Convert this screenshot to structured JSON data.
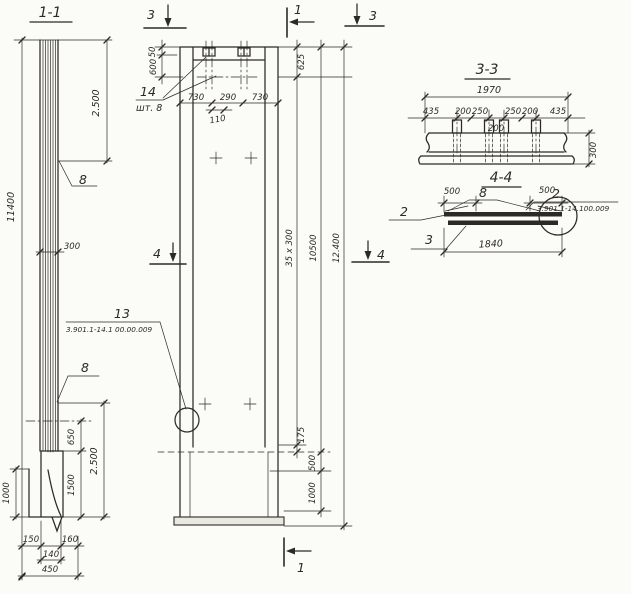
{
  "ink": "#2c2a25",
  "paper": "#fbfbf7",
  "s11": {
    "title": "1-1",
    "dim_total": "11400",
    "dim_top2500": "2.500",
    "dim_300": "300",
    "weld_top": "8",
    "weld_bottom": "8",
    "dim_650": "650",
    "dim_2500b": "2.500",
    "dim_1500": "1500",
    "dim_1000": "1000",
    "dim_150": "150",
    "dim_160": "160",
    "dim_140": "140",
    "dim_450": "450"
  },
  "elevation": {
    "cut3_left": "3",
    "cut3_right": "3",
    "cut1_top": "1",
    "cut1_bottom": "1",
    "cut4_left": "4",
    "cut4_right": "4",
    "dim_50": "50",
    "dim_600": "600",
    "pos_14": "14",
    "qty_14": "шт. 8",
    "dim_730a": "730",
    "dim_290": "290",
    "dim_730b": "730",
    "dim_110": "110",
    "dim_625": "625",
    "dim_35x300": "35 x 300",
    "dim_10500": "10500",
    "dim_12400": "12.400",
    "dim_175": "175",
    "dim_500": "500",
    "dim_1000": "1000",
    "pos_13": "13",
    "ref_13": "3.901.1-14.1 00.00.009"
  },
  "s33": {
    "title": "3-3",
    "dim_1970": "1970",
    "dims": [
      "435",
      "200",
      "250",
      "250",
      "200",
      "435"
    ],
    "dim_200c": "200",
    "dim_300": "300"
  },
  "s44": {
    "title": "4-4",
    "pos_8": "8",
    "dim_500l": "500",
    "dim_500r": "500",
    "pos_2l": "2",
    "pos_3l": "3",
    "dim_1840": "1840",
    "pos_2r": "2",
    "ref_2": "3.901.1-14.100.009"
  }
}
